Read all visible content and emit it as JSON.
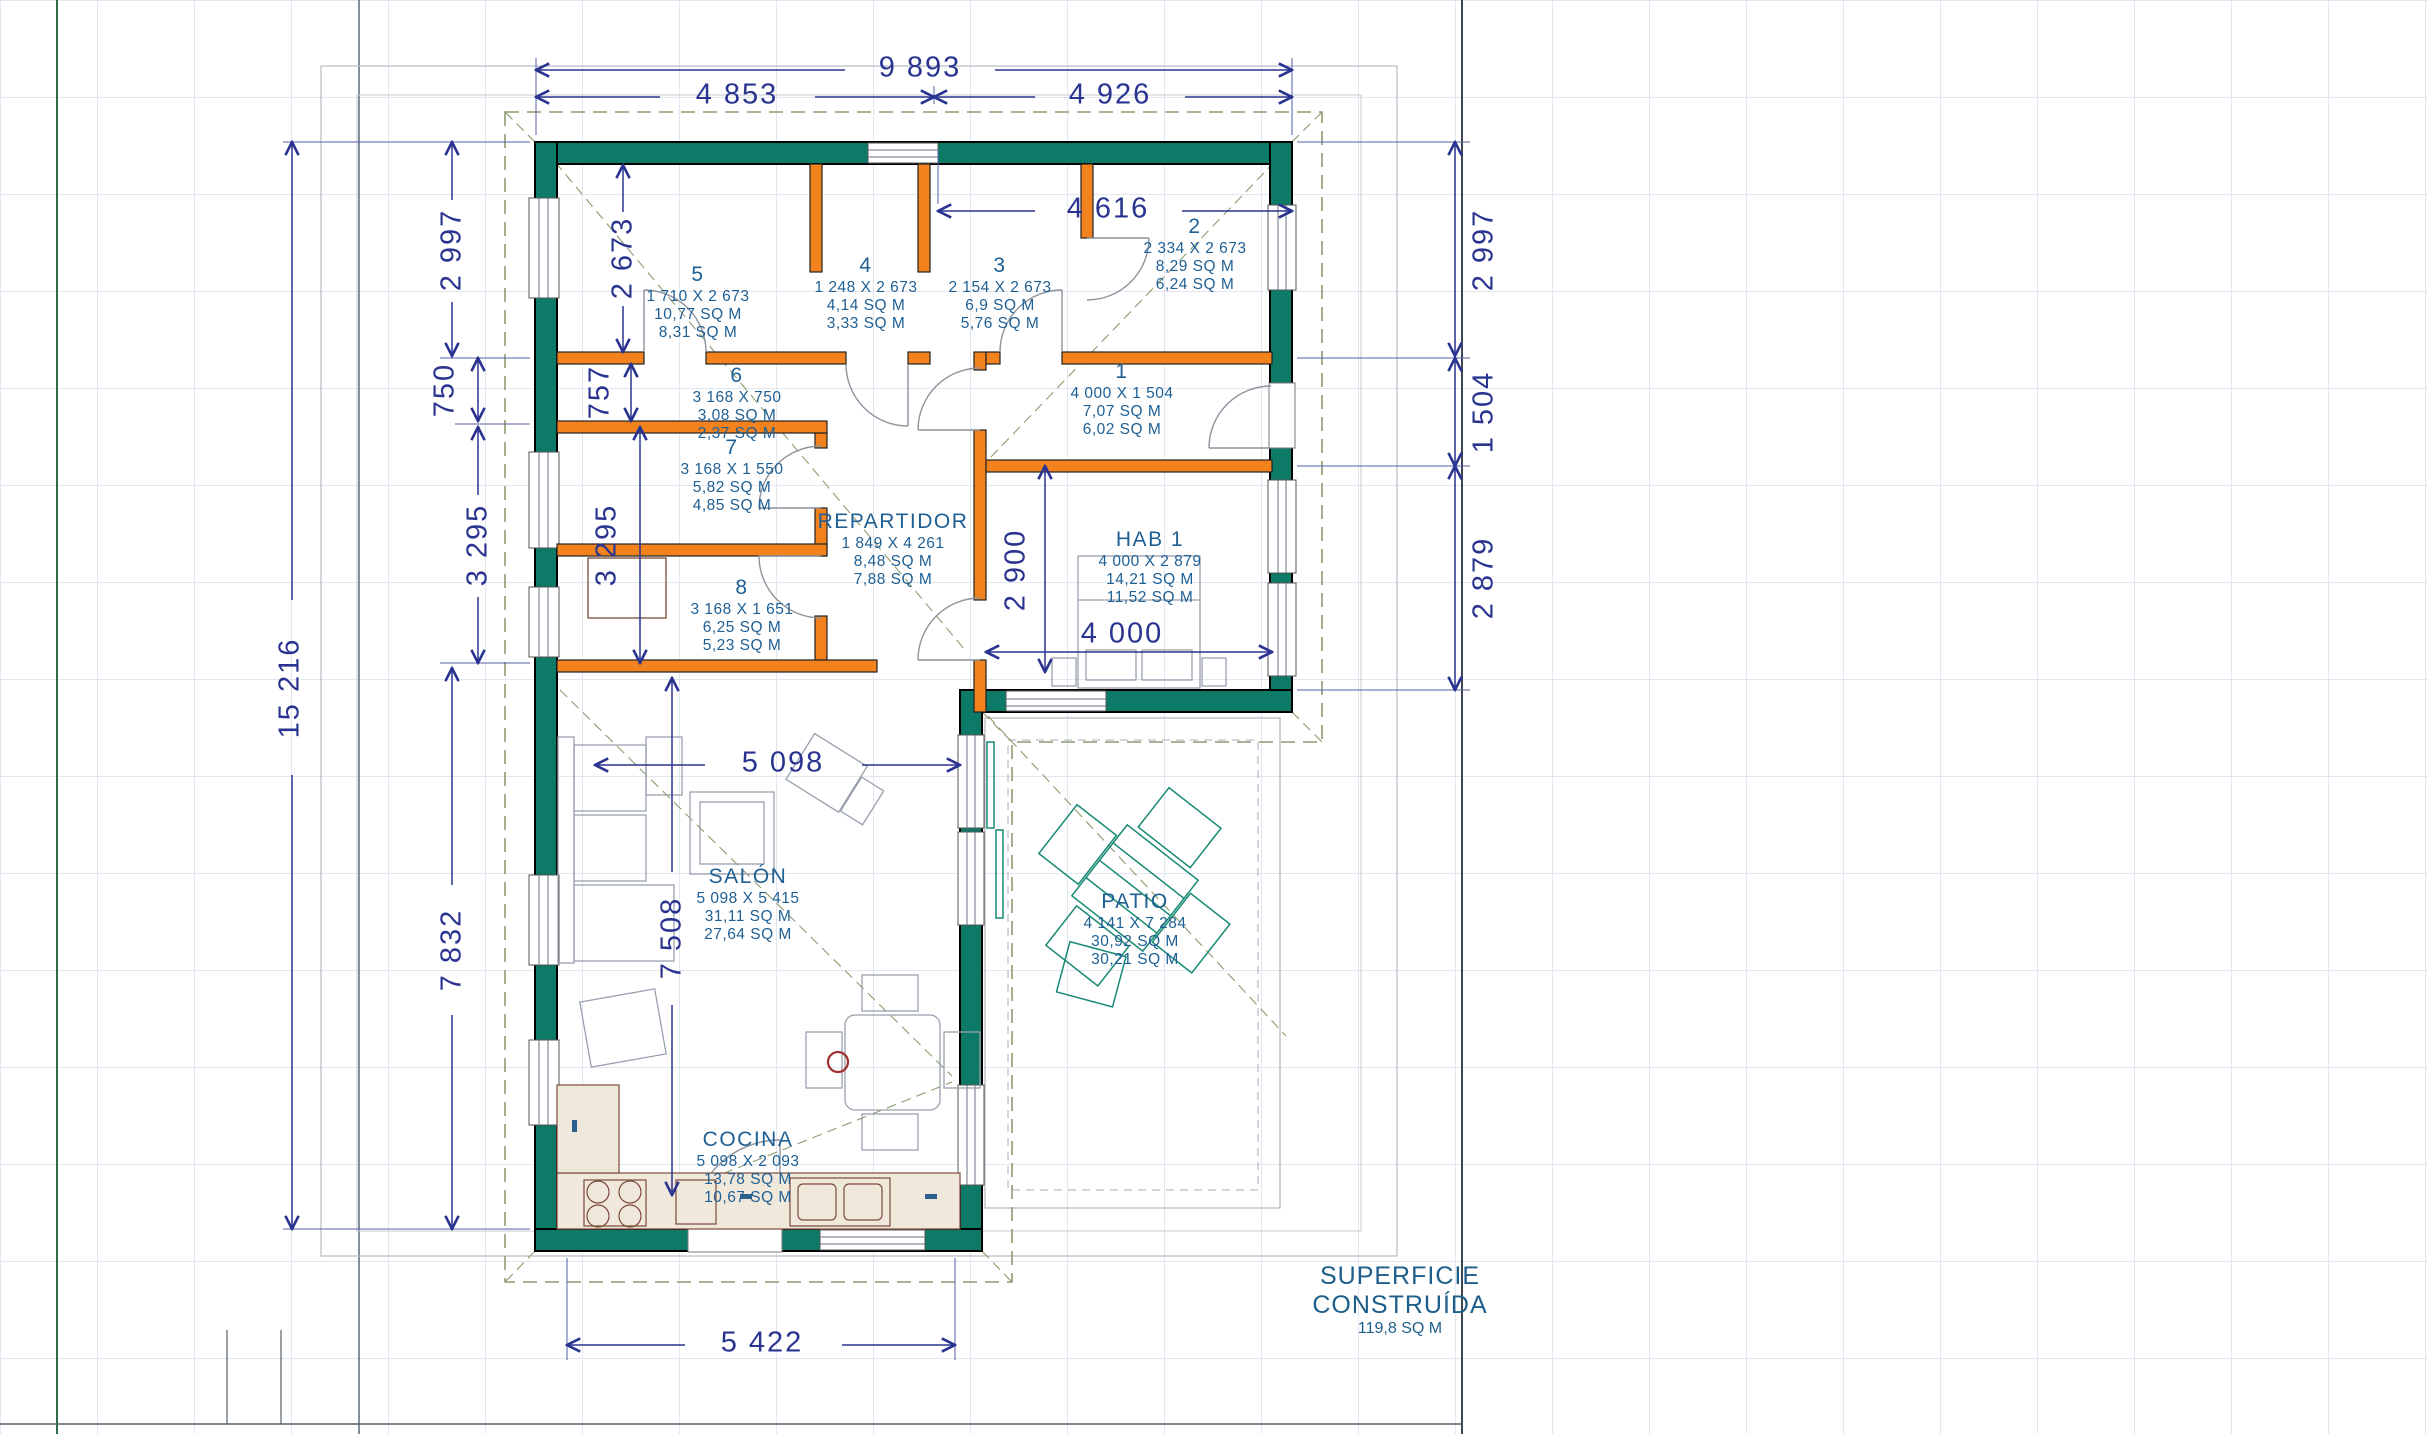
{
  "dims": {
    "top_total": "9 893",
    "top_left": "4 853",
    "top_right": "4 926",
    "entry_width": "4 616",
    "left_total": "15 216",
    "left_upper": "2 997",
    "left_750": "750",
    "left_mid": "3 295",
    "left_lower": "7 832",
    "inner_upper": "2 673",
    "inner_757": "757",
    "inner_mid": "3 295",
    "inner_lower": "7 508",
    "right_upper": "2 997",
    "right_mid": "1 504",
    "right_lower": "2 879",
    "hab_height": "2 900",
    "hab_width": "4 000",
    "salon_width": "5 098",
    "bottom_width": "5 422"
  },
  "rooms": [
    {
      "name": "5",
      "dims": "1 710 X 2 673",
      "area1": "10,77 SQ M",
      "area2": "8,31 SQ M"
    },
    {
      "name": "4",
      "dims": "1 248 X 2 673",
      "area1": "4,14 SQ M",
      "area2": "3,33 SQ M"
    },
    {
      "name": "3",
      "dims": "2 154 X 2 673",
      "area1": "6,9 SQ M",
      "area2": "5,76 SQ M"
    },
    {
      "name": "2",
      "dims": "2 334 X 2 673",
      "area1": "8,29 SQ M",
      "area2": "6,24 SQ M"
    },
    {
      "name": "1",
      "dims": "4 000 X 1 504",
      "area1": "7,07 SQ M",
      "area2": "6,02 SQ M"
    },
    {
      "name": "6",
      "dims": "3 168 X 750",
      "area1": "3,08 SQ M",
      "area2": "2,37 SQ M"
    },
    {
      "name": "7",
      "dims": "3 168 X 1 550",
      "area1": "5,82 SQ M",
      "area2": "4,85 SQ M"
    },
    {
      "name": "8",
      "dims": "3 168 X 1 651",
      "area1": "6,25 SQ M",
      "area2": "5,23 SQ M"
    },
    {
      "name": "REPARTIDOR",
      "dims": "1 849 X 4 261",
      "area1": "8,48 SQ M",
      "area2": "7,88 SQ M"
    },
    {
      "name": "HAB 1",
      "dims": "4 000 X 2 879",
      "area1": "14,21 SQ M",
      "area2": "11,52 SQ M"
    },
    {
      "name": "SALÓN",
      "dims": "5 098 X 5 415",
      "area1": "31,11 SQ M",
      "area2": "27,64 SQ M"
    },
    {
      "name": "COCINA",
      "dims": "5 098 X 2 093",
      "area1": "13,78 SQ M",
      "area2": "10,67 SQ M"
    },
    {
      "name": "PATIO",
      "dims": "4 141 X 7 284",
      "area1": "30,92 SQ M",
      "area2": "30,21 SQ M"
    }
  ],
  "summary": {
    "line1": "SUPERFICIE",
    "line2": "CONSTRUÍDA",
    "area": "119,8 SQ M"
  },
  "colors": {
    "wall": "#0d7a68",
    "partition": "#f2821e",
    "dimension": "#2a3490",
    "room_text": "#1e5f94",
    "roof_dash": "#8d9b70",
    "counter": "#efe8db",
    "patio_furniture": "#178a74"
  }
}
